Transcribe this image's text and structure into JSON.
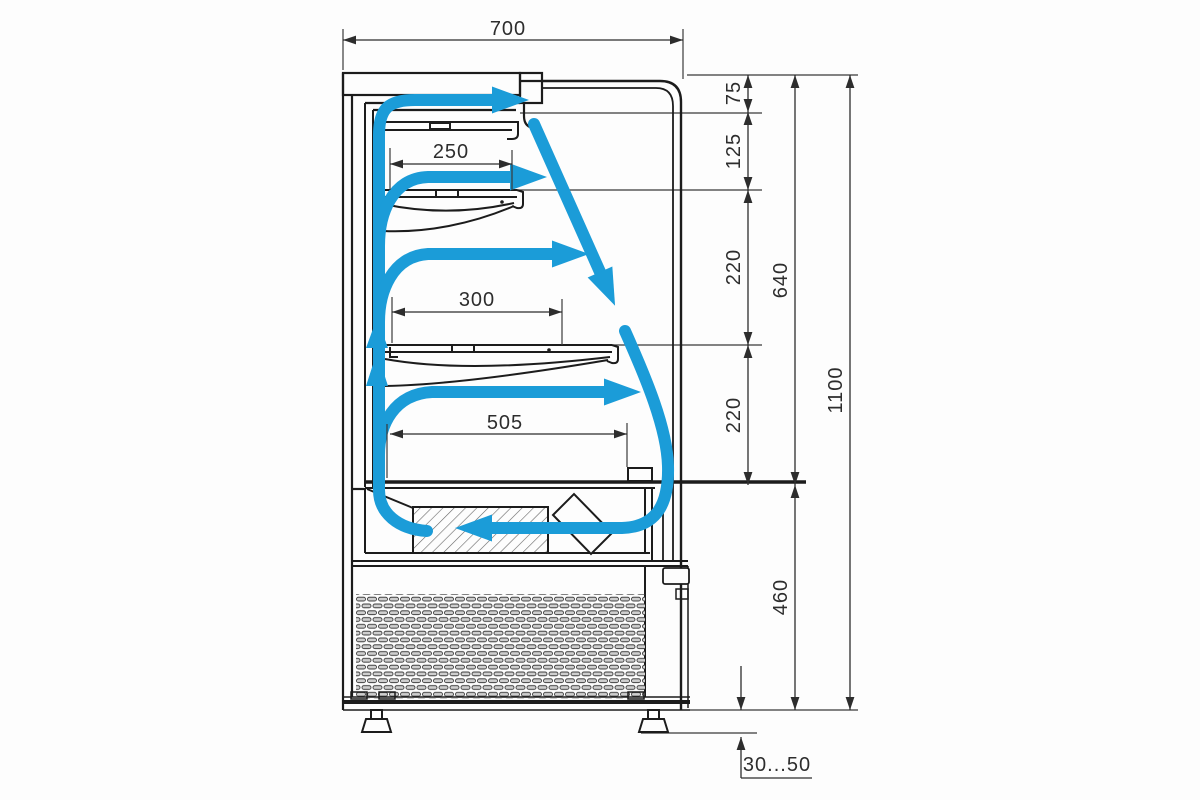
{
  "diagram": {
    "type": "technical-drawing",
    "subject": "refrigerated-display-case-cross-section-with-airflow",
    "labels": {
      "width_top": "700",
      "gap_top": "75",
      "gap_upper": "125",
      "gap_mid": "220",
      "gap_lower": "220",
      "display_zone_height": "640",
      "overall_height": "1100",
      "base_height": "460",
      "shelf_top_depth": "250",
      "shelf_middle_depth": "300",
      "deck_depth": "505",
      "foot_height_range": "30...50"
    },
    "colors": {
      "airflow_arrow": "#1B9CD8",
      "outline": "#1c1c1c",
      "dimension": "#2d2d2d",
      "background": "#fdfdfd",
      "grille_slot_fill": "#cfcfcf"
    }
  }
}
